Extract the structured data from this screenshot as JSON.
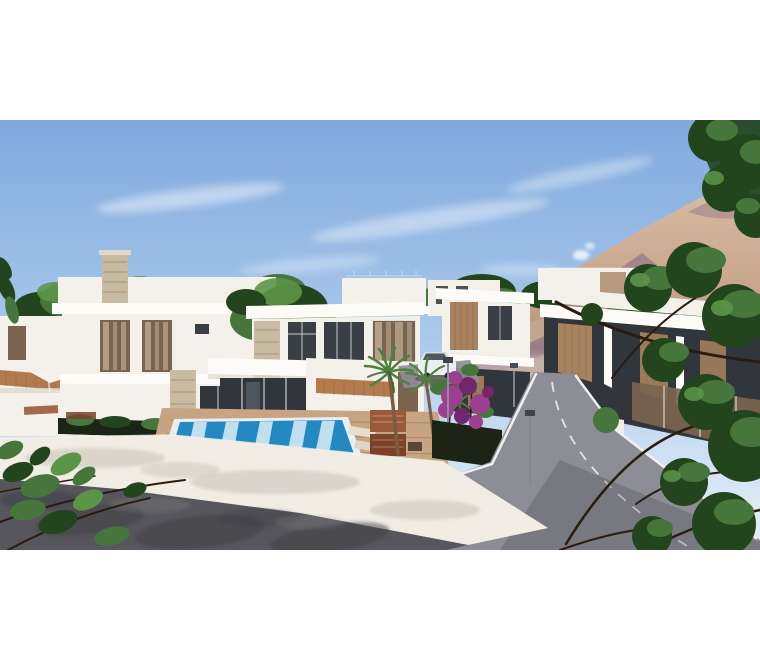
{
  "meta": {
    "image_type": "real-estate-architectural-render",
    "description": "3D rendering of a modern white villa development: central two-storey villa with swimming pool and sun deck, neighbouring villas with dark glass and wood-slat facades, white terrace wall, dark asphalt street in the foreground, side road climbing to the right, bare mountain under a blue sky with thin clouds, palm trees, bougainvillea and dark-green tree branches framing the view. No text or UI controls visible; image is letterboxed with white bars top and bottom."
  },
  "canvas": {
    "width": 760,
    "height": 670,
    "photo": {
      "left": 0,
      "top": 120,
      "width": 760,
      "height": 430
    },
    "letterbox_color": "#ffffff"
  },
  "scene_regions": [
    "sky",
    "clouds",
    "mountain",
    "background-trees",
    "white-villas",
    "swimming-pool",
    "sun-deck",
    "outdoor-furniture",
    "white-terrace-wall",
    "foreground-asphalt-road",
    "side-road",
    "street-lamps",
    "parked-car",
    "palm-trees",
    "bougainvillea",
    "foreground-foliage",
    "chimney-smoke"
  ],
  "colors": {
    "sky_top": "#7fa9de",
    "sky_mid": "#a9c8ea",
    "sky_horizon": "#ddeaf7",
    "cloud": "#ffffff",
    "smoke": "#ffffff",
    "mountain_crest": "#d9bfa6",
    "mountain_lit": "#c8a68c",
    "mountain_base": "#a98a7c",
    "mountain_shadow": "#8c7383",
    "mountain_foothill": "#c2a992",
    "tree_green": "#47763c",
    "tree_dark": "#22451d",
    "leaf_bright": "#5d9547",
    "palm_green": "#4f8040",
    "palm_dark": "#37602c",
    "branch": "#2a1c10",
    "trunk": "#7a5c40",
    "villa_white": "#f4f1eb",
    "villa_bright": "#fcfbf8",
    "villa_shade": "#ded8cd",
    "facade_dark": "#31363c",
    "glass_dark": "#3a3f46",
    "glass_brown": "#79644f",
    "curtain": "#c9b59c",
    "wood": "#a8835f",
    "slat_line": "#8a6a48",
    "stone": "#c9bba2",
    "terracotta": "#b27a4d",
    "pool_deep": "#2489c0",
    "pool_pale": "#cfe7f3",
    "deck": "#c7a482",
    "terrace_white": "#f1ede5",
    "terrace_shadow": "#c6c0b4",
    "road_dark": "#56565c",
    "road_light": "#8d8d95",
    "shadow_dark": "#3c3c44",
    "curb": "#f0f0ee",
    "planter": "#1c2416",
    "flower": "#9c3f8e",
    "flower_dark": "#71276a",
    "furniture": "#9a5a39",
    "furniture_dark": "#7e4228",
    "car_white": "#eceff1"
  }
}
